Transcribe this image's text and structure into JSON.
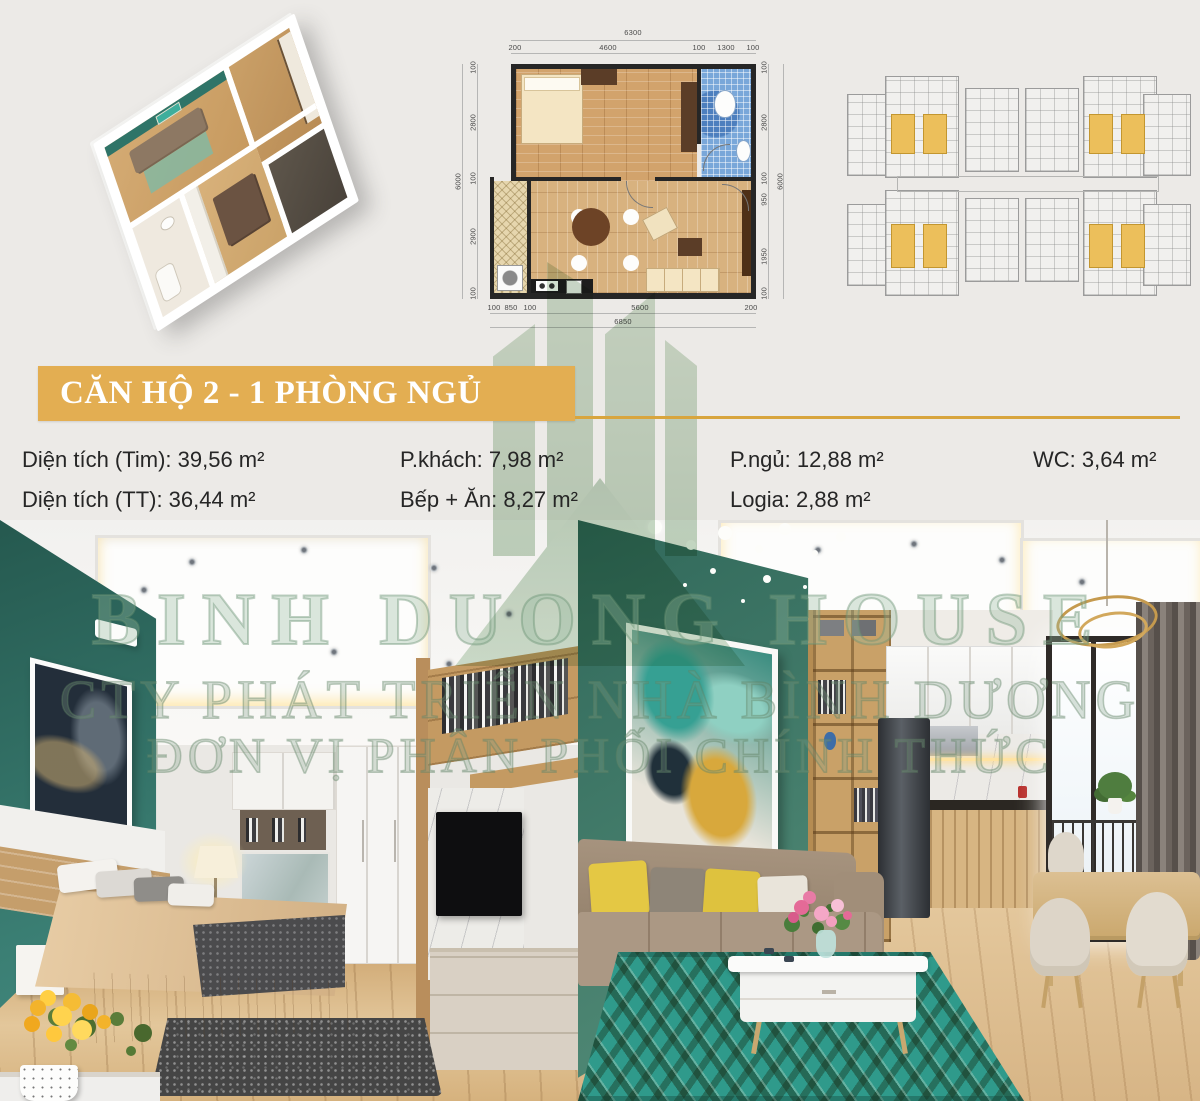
{
  "title": {
    "text": "CĂN HỘ 2 - 1 PHÒNG NGỦ"
  },
  "specs": {
    "items": [
      {
        "text": "Diện tích (Tim): 39,56 m²"
      },
      {
        "text": "Diện tích (TT): 36,44 m²"
      },
      {
        "text": "P.khách: 7,98 m²"
      },
      {
        "text": "Bếp + Ăn: 8,27 m²"
      },
      {
        "text": "P.ngủ: 12,88 m²"
      },
      {
        "text": "Logia: 2,88 m²"
      },
      {
        "text": "WC: 3,64 m²"
      }
    ]
  },
  "floorplan": {
    "dims": {
      "top_total": "6300",
      "top": [
        "200",
        "4600",
        "100",
        "1300",
        "100"
      ],
      "left_total": "6000",
      "left": [
        "100",
        "2800",
        "100",
        "2900",
        "100"
      ],
      "right_total": "6000",
      "right": [
        "100",
        "2800",
        "100",
        "950",
        "1950",
        "100"
      ],
      "bottom": [
        "100",
        "850",
        "100",
        "5600",
        "200"
      ],
      "bottom_total": "6850"
    }
  },
  "watermark": {
    "line1": "BINH DUONG HOUSE",
    "line2": "CTY PHÁT TRIỂN NHÀ BÌNH DƯƠNG",
    "line3": "ĐƠN VỊ PHÂN PHỐI CHÍNH THỨC"
  },
  "colors": {
    "page_bg": "#eceae7",
    "banner_gold": "#e3ae52",
    "rule_gold": "#d8a53e",
    "accent_teal": "#2f7168",
    "green_wall": "#47806c",
    "keyplan_highlight": "#ecbf5b",
    "bathroom_blue": "#79a7d9",
    "wood": "#d5b17e",
    "watermark_green": "#8fae90"
  }
}
